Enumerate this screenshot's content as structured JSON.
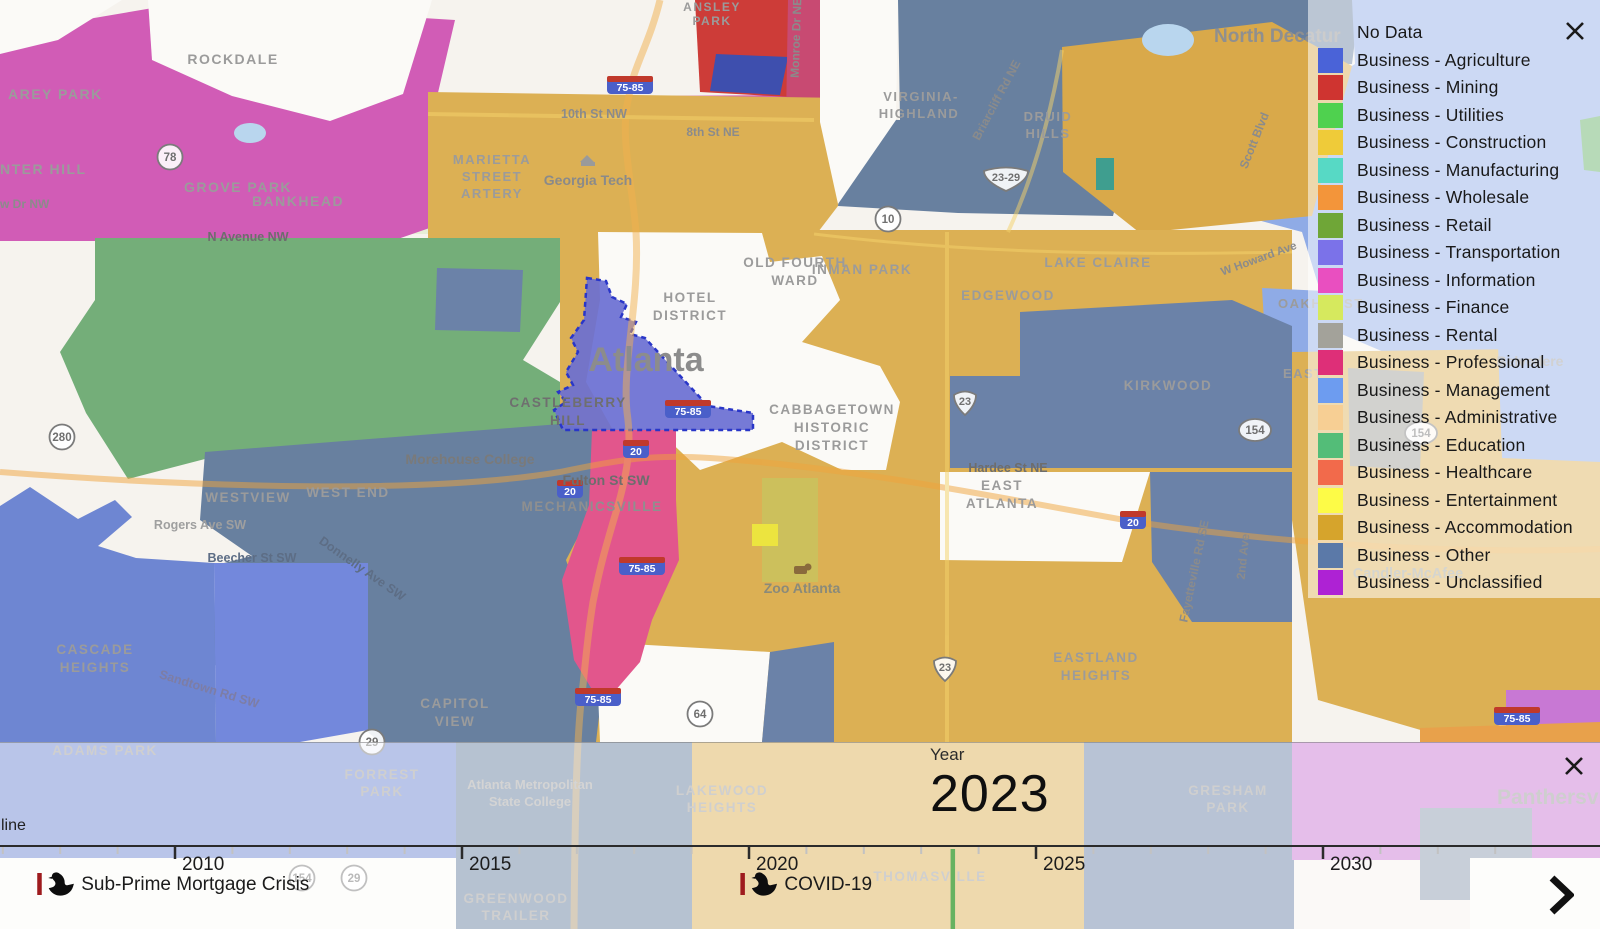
{
  "legend": {
    "close_icon": "x",
    "items": [
      {
        "label": "No Data",
        "color": null
      },
      {
        "label": "Business - Agriculture",
        "color": "#4a63d8"
      },
      {
        "label": "Business - Mining",
        "color": "#cf3430"
      },
      {
        "label": "Business - Utilities",
        "color": "#4fd14f"
      },
      {
        "label": "Business - Construction",
        "color": "#efcb39"
      },
      {
        "label": "Business - Manufacturing",
        "color": "#57d9c5"
      },
      {
        "label": "Business - Wholesale",
        "color": "#f3953a"
      },
      {
        "label": "Business - Retail",
        "color": "#6fa637"
      },
      {
        "label": "Business - Transportation",
        "color": "#7b72e9"
      },
      {
        "label": "Business - Information",
        "color": "#e94fc0"
      },
      {
        "label": "Business - Finance",
        "color": "#d6e95e"
      },
      {
        "label": "Business - Rental",
        "color": "#a3a29a"
      },
      {
        "label": "Business - Professional",
        "color": "#de2f78"
      },
      {
        "label": "Business - Management",
        "color": "#6d9cf0"
      },
      {
        "label": "Business - Administrative",
        "color": "#f7cf94"
      },
      {
        "label": "Business - Education",
        "color": "#53bd78"
      },
      {
        "label": "Business - Healthcare",
        "color": "#f26a4b"
      },
      {
        "label": "Business - Entertainment",
        "color": "#fdfb47"
      },
      {
        "label": "Business - Accommodation",
        "color": "#d6a42c"
      },
      {
        "label": "Business - Other",
        "color": "#5b79a8"
      },
      {
        "label": "Business - Unclassified",
        "color": "#ae22d4"
      }
    ]
  },
  "timeline": {
    "partial_label": "line",
    "year_label": "Year",
    "current_year": "2023",
    "marker_year": 2023.55,
    "marker_color": "#67b261",
    "axis": {
      "x_2010": 175,
      "px_per_year": 57.4,
      "major_ticks": [
        2010,
        2015,
        2020,
        2025,
        2030
      ],
      "minor_tick_start": 2007,
      "minor_tick_end": 2033
    },
    "events": [
      {
        "label": "Sub-Prime Mortgage Crisis",
        "year": 2007.6
      },
      {
        "label": "COVID-19",
        "year": 2019.85
      }
    ],
    "event_bar_color": "#9e1b1e"
  },
  "map": {
    "city_label": "Atlanta",
    "labels": [
      {
        "t": "AREY PARK",
        "x": 8,
        "y": 99,
        "a": "start",
        "s": 14
      },
      {
        "t": "ROCKDALE",
        "x": 233,
        "y": 64,
        "s": 14
      },
      {
        "t": "NTER HILL",
        "x": 0,
        "y": 174,
        "a": "start",
        "s": 14
      },
      {
        "t": "w Dr NW",
        "x": 0,
        "y": 208,
        "a": "start",
        "s": 12,
        "c": "#8b8b8b",
        "ls": 0
      },
      {
        "t": "GROVE PARK",
        "x": 238,
        "y": 192,
        "s": 14
      },
      {
        "t": "BANKHEAD",
        "x": 298,
        "y": 206,
        "s": 14
      },
      {
        "t": "N Avenue NW",
        "x": 248,
        "y": 241,
        "s": 12.5,
        "c": "#6d6d6d",
        "ls": 0
      },
      {
        "t": "ANSLEY",
        "x": 712,
        "y": 11,
        "s": 12
      },
      {
        "t": "PARK",
        "x": 712,
        "y": 25,
        "s": 12
      },
      {
        "t": "10th St NW",
        "x": 594,
        "y": 118,
        "s": 12.5,
        "c": "#8b8b8b",
        "ls": 0
      },
      {
        "t": "8th St NE",
        "x": 713,
        "y": 136,
        "s": 12,
        "c": "#8b8b8b",
        "ls": 0
      },
      {
        "t": "MARIETTA",
        "x": 492,
        "y": 164,
        "s": 13
      },
      {
        "t": "STREET",
        "x": 492,
        "y": 181,
        "s": 13
      },
      {
        "t": "ARTERY",
        "x": 492,
        "y": 198,
        "s": 13
      },
      {
        "t": "Georgia Tech",
        "x": 588,
        "y": 185,
        "s": 14,
        "c": "#8a8a8a",
        "w": 700,
        "ls": 0
      },
      {
        "t": "Monroe Dr NE",
        "x": 800,
        "y": 38,
        "s": 12,
        "r": -88,
        "c": "#8b8b8b",
        "ls": 0
      },
      {
        "t": "VIRGINIA-",
        "x": 921,
        "y": 101,
        "s": 13
      },
      {
        "t": "HIGHLAND",
        "x": 919,
        "y": 118,
        "s": 13
      },
      {
        "t": "Briarcliff Rd NE",
        "x": 1000,
        "y": 102,
        "s": 12,
        "r": -62,
        "c": "#8b8b8b",
        "ls": 0
      },
      {
        "t": "DRUID",
        "x": 1048,
        "y": 121,
        "s": 13
      },
      {
        "t": "HILLS",
        "x": 1048,
        "y": 138,
        "s": 13
      },
      {
        "t": "North Decatur",
        "x": 1214,
        "y": 42,
        "s": 19,
        "a": "start",
        "c": "#8f8f8f",
        "w": 700,
        "ls": 0
      },
      {
        "t": "Scott Blvd",
        "x": 1258,
        "y": 142,
        "s": 12,
        "r": -68,
        "c": "#8b8b8b",
        "ls": 0
      },
      {
        "t": "W Howard Ave",
        "x": 1260,
        "y": 262,
        "s": 11.5,
        "r": -20,
        "c": "#8b8b8b",
        "ls": 0
      },
      {
        "t": "OAKHURST",
        "x": 1278,
        "y": 308,
        "s": 13,
        "a": "start"
      },
      {
        "t": "OLD FOURTH",
        "x": 795,
        "y": 267,
        "s": 13.5
      },
      {
        "t": "WARD",
        "x": 795,
        "y": 285,
        "s": 13.5
      },
      {
        "t": "HOTEL",
        "x": 690,
        "y": 302,
        "s": 13.5
      },
      {
        "t": "DISTRICT",
        "x": 690,
        "y": 320,
        "s": 13.5
      },
      {
        "t": "INMAN PARK",
        "x": 862,
        "y": 274,
        "s": 13.5
      },
      {
        "t": "LAKE CLAIRE",
        "x": 1098,
        "y": 267,
        "s": 13.5
      },
      {
        "t": "EDGEWOOD",
        "x": 1008,
        "y": 300,
        "s": 13.5
      },
      {
        "t": "KIRKWOOD",
        "x": 1168,
        "y": 390,
        "s": 13.5
      },
      {
        "t": "EAST",
        "x": 1283,
        "y": 378,
        "s": 13,
        "a": "start"
      },
      {
        "t": "Hardee St NE",
        "x": 1008,
        "y": 472,
        "s": 12.5,
        "c": "#6d6d6d",
        "ls": 0
      },
      {
        "t": "Atlanta",
        "x": 646,
        "y": 371,
        "s": 34,
        "c": "#8c8c8c",
        "w": 600,
        "ls": 0
      },
      {
        "t": "CASTLEBERRY",
        "x": 568,
        "y": 407,
        "s": 13.5,
        "c": "#6f6f6f"
      },
      {
        "t": "HILL",
        "x": 568,
        "y": 425,
        "s": 13.5,
        "c": "#6f6f6f"
      },
      {
        "t": "CABBAGETOWN",
        "x": 832,
        "y": 414,
        "s": 13.5
      },
      {
        "t": "HISTORIC",
        "x": 832,
        "y": 432,
        "s": 13.5
      },
      {
        "t": "DISTRICT",
        "x": 832,
        "y": 450,
        "s": 13.5
      },
      {
        "t": "Fulton St SW",
        "x": 606,
        "y": 485,
        "s": 14,
        "c": "#6d6d6d",
        "ls": 0
      },
      {
        "t": "MECHANICSVILLE",
        "x": 592,
        "y": 511,
        "s": 13.5,
        "c": "#8f8f8f"
      },
      {
        "t": "Morehouse College",
        "x": 470,
        "y": 464,
        "s": 14,
        "c": "#7a7a7a",
        "w": 700,
        "ls": 0
      },
      {
        "t": "WESTVIEW",
        "x": 248,
        "y": 502,
        "s": 13.5
      },
      {
        "t": "WEST END",
        "x": 348,
        "y": 497,
        "s": 13.5
      },
      {
        "t": "Rogers Ave SW",
        "x": 200,
        "y": 529,
        "s": 12.5,
        "c": "#9f9f9f",
        "ls": 0
      },
      {
        "t": "Beecher St SW",
        "x": 252,
        "y": 562,
        "s": 12.5,
        "c": "#5d6d85",
        "ls": 0
      },
      {
        "t": "Donnelly Ave SW",
        "x": 360,
        "y": 572,
        "s": 12.5,
        "r": 35,
        "c": "#5d6d85",
        "ls": 0
      },
      {
        "t": "CASCADE",
        "x": 95,
        "y": 654,
        "s": 13.5
      },
      {
        "t": "HEIGHTS",
        "x": 95,
        "y": 672,
        "s": 13.5
      },
      {
        "t": "Sandtown Rd SW",
        "x": 208,
        "y": 693,
        "s": 12.5,
        "r": 17,
        "c": "#7d7da5",
        "ls": 0
      },
      {
        "t": "CAPITOL",
        "x": 455,
        "y": 708,
        "s": 13.5
      },
      {
        "t": "VIEW",
        "x": 455,
        "y": 726,
        "s": 13.5
      },
      {
        "t": "Zoo Atlanta",
        "x": 802,
        "y": 593,
        "s": 14,
        "c": "#8a8a7a",
        "w": 700,
        "ls": 0
      },
      {
        "t": "EAST",
        "x": 1002,
        "y": 490,
        "s": 13.5
      },
      {
        "t": "ATLANTA",
        "x": 1002,
        "y": 508,
        "s": 13.5
      },
      {
        "t": "EASTLAND",
        "x": 1096,
        "y": 662,
        "s": 13.5
      },
      {
        "t": "HEIGHTS",
        "x": 1096,
        "y": 680,
        "s": 13.5
      },
      {
        "t": "Fayetteville Rd SE",
        "x": 1198,
        "y": 572,
        "s": 12,
        "r": -78,
        "c": "#8b8b8b",
        "ls": 0
      },
      {
        "t": "2nd Ave",
        "x": 1247,
        "y": 557,
        "s": 12,
        "r": -84,
        "c": "#8b8b8b",
        "ls": 0
      },
      {
        "t": "Belvedere",
        "x": 1530,
        "y": 366,
        "s": 14,
        "c": "#9a9a9a",
        "w": 700,
        "ls": 0
      },
      {
        "t": "Candler-McAfee",
        "x": 1408,
        "y": 578,
        "s": 14.5,
        "c": "#a3a394",
        "w": 700,
        "ls": 0
      },
      {
        "t": "ADAMS PARK",
        "x": 105,
        "y": 755,
        "s": 13.5
      },
      {
        "t": "FORREST",
        "x": 382,
        "y": 779,
        "s": 13.5
      },
      {
        "t": "PARK",
        "x": 382,
        "y": 796,
        "s": 13.5
      },
      {
        "t": "Atlanta Metropolitan",
        "x": 530,
        "y": 789,
        "s": 13,
        "c": "#a5a5a5",
        "ls": 0
      },
      {
        "t": "State College",
        "x": 530,
        "y": 806,
        "s": 13,
        "c": "#a5a5a5",
        "ls": 0
      },
      {
        "t": "LAKEWOOD",
        "x": 722,
        "y": 795,
        "s": 13.5
      },
      {
        "t": "HEIGHTS",
        "x": 722,
        "y": 812,
        "s": 13.5
      },
      {
        "t": "GREENWOOD",
        "x": 516,
        "y": 903,
        "s": 13.5
      },
      {
        "t": "TRAILER",
        "x": 516,
        "y": 920,
        "s": 13.5
      },
      {
        "t": "THOMASVILLE",
        "x": 930,
        "y": 881,
        "s": 13.5
      },
      {
        "t": "GRESHAM",
        "x": 1228,
        "y": 795,
        "s": 13.5
      },
      {
        "t": "PARK",
        "x": 1228,
        "y": 812,
        "s": 13.5
      },
      {
        "t": "Panthersville",
        "x": 1497,
        "y": 804,
        "s": 21,
        "a": "start",
        "c": "#9a9a9a",
        "w": 600,
        "ls": 0
      }
    ],
    "shields": [
      {
        "kind": "circle",
        "t": "78",
        "x": 170,
        "y": 157
      },
      {
        "kind": "circle",
        "t": "280",
        "x": 62,
        "y": 437
      },
      {
        "kind": "circle",
        "t": "10",
        "x": 888,
        "y": 219
      },
      {
        "kind": "circle",
        "t": "64",
        "x": 700,
        "y": 714
      },
      {
        "kind": "circle",
        "t": "29",
        "x": 372,
        "y": 742
      },
      {
        "kind": "circle",
        "t": "154",
        "x": 302,
        "y": 878
      },
      {
        "kind": "circle",
        "t": "29",
        "x": 354,
        "y": 878
      },
      {
        "kind": "oval",
        "t": "154",
        "x": 1255,
        "y": 430
      },
      {
        "kind": "oval",
        "t": "154",
        "x": 1421,
        "y": 433
      },
      {
        "kind": "us",
        "t": "23",
        "x": 965,
        "y": 402
      },
      {
        "kind": "us",
        "t": "23",
        "x": 945,
        "y": 668
      },
      {
        "kind": "usw",
        "t": "23-29",
        "x": 1006,
        "y": 178
      },
      {
        "kind": "i",
        "t": "75-85",
        "x": 630,
        "y": 85
      },
      {
        "kind": "i",
        "t": "75-85",
        "x": 688,
        "y": 409
      },
      {
        "kind": "i",
        "t": "75-85",
        "x": 642,
        "y": 566
      },
      {
        "kind": "i",
        "t": "75-85",
        "x": 598,
        "y": 697
      },
      {
        "kind": "i",
        "t": "75-85",
        "x": 1517,
        "y": 716
      },
      {
        "kind": "i",
        "t": "20",
        "x": 636,
        "y": 449
      },
      {
        "kind": "i",
        "t": "20",
        "x": 1133,
        "y": 520
      },
      {
        "kind": "i",
        "t": "20",
        "x": 570,
        "y": 489
      }
    ]
  }
}
